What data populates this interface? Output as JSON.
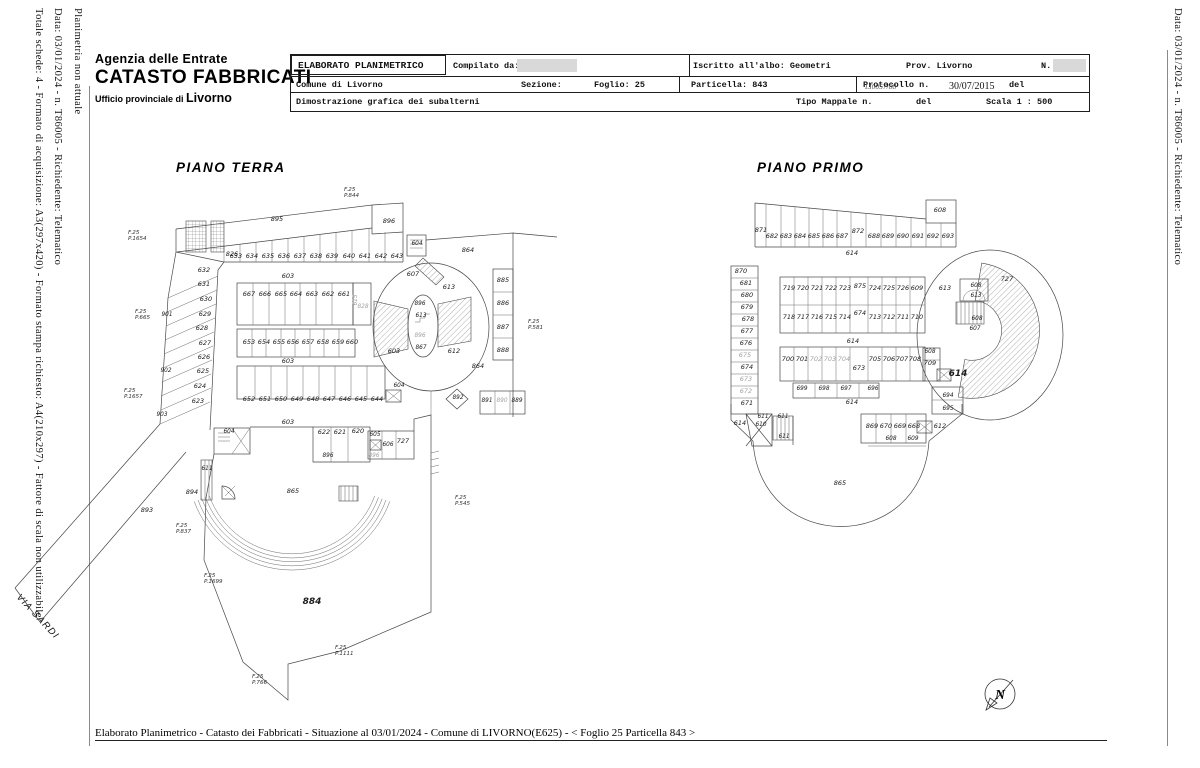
{
  "header": {
    "agency": "Agenzia delle Entrate",
    "registry": "CATASTO FABBRICATI",
    "office_prefix": "Ufficio provinciale di",
    "office_city": "Livorno"
  },
  "margins": {
    "left_1": "Planimetria non attuale",
    "left_2": "Data: 03/01/2024 - n. T86005 - Richiedente: Telematico",
    "left_3": "Totale schede: 4 - Formato di acquisizione: A3(297x420) - Formato stampa richiesto: A4(210x297) - Fattore di scala non utilizzabile",
    "right_1": "Data: 03/01/2024 - n. T86005 - Richiedente: Telematico"
  },
  "form": {
    "title": "ELABORATO PLANIMETRICO",
    "compilato_da": "Compilato da:",
    "iscritto": "Iscritto all'albo: Geometri",
    "prov": "Prov. Livorno",
    "n_label": "N.",
    "comune": "Comune di Livorno",
    "sezione": "Sezione:",
    "foglio": "Foglio: 25",
    "particella": "Particella: 843",
    "protocollo": "Protocollo n.",
    "protocollo_overlap": "LI0057/88",
    "data_protocollo": "30/07/2015",
    "del1": "del",
    "dimostrazione": "Dimostrazione grafica dei subalterni",
    "tipo_mappale": "Tipo Mappale n.",
    "del2": "del",
    "scala": "Scala 1 : 500"
  },
  "street": "VIA SARDI",
  "compass": {
    "letter": "N"
  },
  "footer": "Elaborato Planimetrico - Catasto dei Fabbricati - Situazione al 03/01/2024 - Comune di LIVORNO(E625) - < Foglio 25 Particella 843 >",
  "plans": {
    "terra": {
      "title": "PIANO TERRA",
      "labels": [
        [
          277,
          221,
          "895"
        ],
        [
          389,
          223,
          "896"
        ],
        [
          232,
          256,
          "826"
        ],
        [
          236,
          258,
          "633"
        ],
        [
          252,
          258,
          "634"
        ],
        [
          268,
          258,
          "635"
        ],
        [
          284,
          258,
          "636"
        ],
        [
          300,
          258,
          "637"
        ],
        [
          316,
          258,
          "638"
        ],
        [
          332,
          258,
          "639"
        ],
        [
          349,
          258,
          "640"
        ],
        [
          365,
          258,
          "641"
        ],
        [
          381,
          258,
          "642"
        ],
        [
          397,
          258,
          "643"
        ],
        [
          417,
          245,
          "604",
          "s"
        ],
        [
          204,
          272,
          "632"
        ],
        [
          204,
          286,
          "631"
        ],
        [
          206,
          301,
          "630"
        ],
        [
          205,
          316,
          "629"
        ],
        [
          202,
          330,
          "628"
        ],
        [
          205,
          345,
          "627"
        ],
        [
          204,
          359,
          "626"
        ],
        [
          203,
          373,
          "625"
        ],
        [
          200,
          388,
          "624"
        ],
        [
          198,
          403,
          "623"
        ],
        [
          167,
          316,
          "901",
          "s"
        ],
        [
          166,
          372,
          "902",
          "s"
        ],
        [
          162,
          416,
          "903",
          "s"
        ],
        [
          249,
          296,
          "667"
        ],
        [
          265,
          296,
          "666"
        ],
        [
          281,
          296,
          "665"
        ],
        [
          296,
          296,
          "664"
        ],
        [
          312,
          296,
          "663"
        ],
        [
          328,
          296,
          "662"
        ],
        [
          344,
          296,
          "661"
        ],
        [
          357,
          300,
          "615",
          "gsv"
        ],
        [
          363,
          308,
          "828",
          "gs"
        ],
        [
          249,
          344,
          "653"
        ],
        [
          264,
          344,
          "654"
        ],
        [
          279,
          344,
          "655"
        ],
        [
          293,
          344,
          "656"
        ],
        [
          308,
          344,
          "657"
        ],
        [
          323,
          344,
          "658"
        ],
        [
          338,
          344,
          "659"
        ],
        [
          352,
          344,
          "660"
        ],
        [
          249,
          401,
          "652"
        ],
        [
          265,
          401,
          "651"
        ],
        [
          281,
          401,
          "650"
        ],
        [
          297,
          401,
          "649"
        ],
        [
          313,
          401,
          "648"
        ],
        [
          329,
          401,
          "647"
        ],
        [
          345,
          401,
          "646"
        ],
        [
          361,
          401,
          "645"
        ],
        [
          377,
          401,
          "644"
        ],
        [
          288,
          278,
          "603"
        ],
        [
          288,
          363,
          "603"
        ],
        [
          288,
          424,
          "603"
        ],
        [
          394,
          353,
          "603"
        ],
        [
          413,
          276,
          "607"
        ],
        [
          449,
          289,
          "613"
        ],
        [
          468,
          252,
          "864"
        ],
        [
          420,
          305,
          "896",
          "s"
        ],
        [
          421,
          317,
          "613",
          "s"
        ],
        [
          420,
          337,
          "896",
          "gs"
        ],
        [
          421,
          349,
          "867",
          "s"
        ],
        [
          454,
          353,
          "612"
        ],
        [
          478,
          368,
          "864"
        ],
        [
          399,
          387,
          "604",
          "s"
        ],
        [
          458,
          399,
          "892",
          "s"
        ],
        [
          487,
          402,
          "891",
          "s"
        ],
        [
          502,
          402,
          "890",
          "gs"
        ],
        [
          517,
          402,
          "889",
          "s"
        ],
        [
          503,
          282,
          "885"
        ],
        [
          503,
          305,
          "886"
        ],
        [
          503,
          329,
          "887"
        ],
        [
          503,
          352,
          "888"
        ],
        [
          324,
          434,
          "622"
        ],
        [
          340,
          434,
          "621"
        ],
        [
          358,
          433,
          "620"
        ],
        [
          328,
          457,
          "896",
          "s"
        ],
        [
          375,
          436,
          "605",
          "s"
        ],
        [
          388,
          446,
          "606",
          "s"
        ],
        [
          403,
          443,
          "727"
        ],
        [
          374,
          457,
          "896",
          "gs"
        ],
        [
          229,
          433,
          "604",
          "s"
        ],
        [
          207,
          470,
          "611",
          "s"
        ],
        [
          192,
          494,
          "894"
        ],
        [
          147,
          512,
          "893"
        ],
        [
          293,
          493,
          "865"
        ],
        [
          312,
          604,
          "884",
          "b"
        ],
        [
          344,
          191,
          "F.25\nP.844"
        ],
        [
          128,
          234,
          "F.25\nP.1654"
        ],
        [
          135,
          313,
          "F.25\nP.665"
        ],
        [
          124,
          392,
          "F.25\nP.1657"
        ],
        [
          528,
          323,
          "F.25\nP.581"
        ],
        [
          455,
          499,
          "F.25\nP.545"
        ],
        [
          176,
          527,
          "F.25\nP.837"
        ],
        [
          204,
          577,
          "F.25\nP.1699"
        ],
        [
          335,
          649,
          "F.25\nP.1111"
        ],
        [
          252,
          678,
          "F.25\nP.766"
        ]
      ]
    },
    "primo": {
      "title": "PIANO PRIMO",
      "labels": [
        [
          761,
          232,
          "871"
        ],
        [
          772,
          238,
          "682"
        ],
        [
          786,
          238,
          "683"
        ],
        [
          800,
          238,
          "684"
        ],
        [
          814,
          238,
          "685"
        ],
        [
          828,
          238,
          "686"
        ],
        [
          842,
          238,
          "687"
        ],
        [
          858,
          233,
          "872"
        ],
        [
          874,
          238,
          "688"
        ],
        [
          888,
          238,
          "689"
        ],
        [
          903,
          238,
          "690"
        ],
        [
          918,
          238,
          "691"
        ],
        [
          933,
          238,
          "692"
        ],
        [
          948,
          238,
          "693"
        ],
        [
          940,
          212,
          "608"
        ],
        [
          852,
          255,
          "614"
        ],
        [
          853,
          343,
          "614"
        ],
        [
          852,
          404,
          "614"
        ],
        [
          741,
          273,
          "870"
        ],
        [
          746,
          285,
          "681"
        ],
        [
          747,
          297,
          "680"
        ],
        [
          747,
          309,
          "679"
        ],
        [
          748,
          321,
          "678"
        ],
        [
          747,
          333,
          "677"
        ],
        [
          746,
          345,
          "676"
        ],
        [
          745,
          357,
          "675",
          "g"
        ],
        [
          747,
          369,
          "674"
        ],
        [
          746,
          381,
          "673",
          "g"
        ],
        [
          746,
          393,
          "672",
          "g"
        ],
        [
          747,
          405,
          "671"
        ],
        [
          740,
          425,
          "614"
        ],
        [
          789,
          290,
          "719"
        ],
        [
          803,
          290,
          "720"
        ],
        [
          817,
          290,
          "721"
        ],
        [
          831,
          290,
          "722"
        ],
        [
          845,
          290,
          "723"
        ],
        [
          860,
          288,
          "875"
        ],
        [
          875,
          290,
          "724"
        ],
        [
          889,
          290,
          "725"
        ],
        [
          903,
          290,
          "726"
        ],
        [
          917,
          290,
          "609"
        ],
        [
          789,
          319,
          "718"
        ],
        [
          803,
          319,
          "717"
        ],
        [
          817,
          319,
          "716"
        ],
        [
          831,
          319,
          "715"
        ],
        [
          845,
          319,
          "714"
        ],
        [
          860,
          315,
          "674"
        ],
        [
          875,
          319,
          "713"
        ],
        [
          889,
          319,
          "712"
        ],
        [
          903,
          319,
          "711"
        ],
        [
          917,
          319,
          "710"
        ],
        [
          788,
          361,
          "700"
        ],
        [
          802,
          361,
          "701"
        ],
        [
          816,
          361,
          "702",
          "g"
        ],
        [
          830,
          361,
          "703",
          "g"
        ],
        [
          844,
          361,
          "704",
          "g"
        ],
        [
          859,
          370,
          "673"
        ],
        [
          875,
          361,
          "705"
        ],
        [
          889,
          361,
          "706"
        ],
        [
          902,
          361,
          "707"
        ],
        [
          915,
          361,
          "708"
        ],
        [
          930,
          353,
          "608",
          "s"
        ],
        [
          930,
          365,
          "709"
        ],
        [
          802,
          390,
          "699",
          "s"
        ],
        [
          824,
          390,
          "698",
          "s"
        ],
        [
          846,
          390,
          "697",
          "s"
        ],
        [
          873,
          390,
          "696",
          "s"
        ],
        [
          958,
          376,
          "614",
          "b"
        ],
        [
          948,
          397,
          "694",
          "s"
        ],
        [
          948,
          410,
          "695",
          "s"
        ],
        [
          872,
          428,
          "869"
        ],
        [
          886,
          428,
          "670"
        ],
        [
          900,
          428,
          "669"
        ],
        [
          914,
          428,
          "668"
        ],
        [
          940,
          428,
          "612"
        ],
        [
          891,
          440,
          "608",
          "s"
        ],
        [
          913,
          440,
          "609",
          "s"
        ],
        [
          763,
          418,
          "611",
          "s"
        ],
        [
          783,
          418,
          "611",
          "s"
        ],
        [
          761,
          426,
          "610",
          "s"
        ],
        [
          784,
          438,
          "611",
          "s"
        ],
        [
          840,
          485,
          "865"
        ],
        [
          945,
          290,
          "613"
        ],
        [
          1007,
          281,
          "727"
        ],
        [
          976,
          287,
          "608",
          "s"
        ],
        [
          976,
          297,
          "613",
          "s"
        ],
        [
          977,
          320,
          "608",
          "s"
        ],
        [
          975,
          330,
          "607",
          "s"
        ]
      ]
    }
  }
}
